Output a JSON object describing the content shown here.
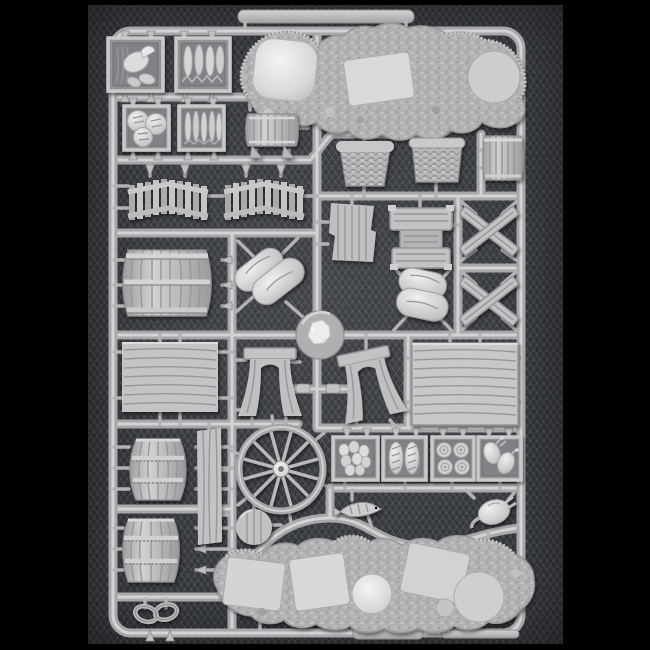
{
  "scene": {
    "type": "photograph",
    "subject": "Injection-moulded light-grey plastic model sprue of miniature wargaming baggage and scenery accessories",
    "background": "dark charcoal herringbone-weave fabric",
    "framing": "black letterbox bars at left, right, top and bottom edges",
    "visible_text": "none"
  },
  "colors": {
    "letterbox": "#000000",
    "fabric": "#3a3d41",
    "plastic_base": "#b4b4b7",
    "plastic_highlight": "#e9e9eb",
    "plastic_shadow": "#8a8a8d"
  },
  "sprue": {
    "frame": "rounded rectangular runner frame with moulded blank label tabs on top and bottom rails",
    "hub": "central circular injection hub with rough gate nub",
    "parts": [
      {
        "name": "crate-of-meat",
        "qty": 1,
        "location": "top-left, row 1 left"
      },
      {
        "name": "crate-of-fish",
        "qty": 1,
        "location": "top-left, row 1 right"
      },
      {
        "name": "crate-of-bread-loaves",
        "qty": 1,
        "location": "top-left, row 2 left"
      },
      {
        "name": "crate-of-dried-fish",
        "qty": 1,
        "location": "top-left, row 2 right"
      },
      {
        "name": "angled-plank-fence-section",
        "qty": 2,
        "location": "left, third row"
      },
      {
        "name": "large-banded-cask",
        "qty": 1,
        "location": "left middle"
      },
      {
        "name": "small-cask-on-stand",
        "qty": 1,
        "location": "upper middle-left"
      },
      {
        "name": "rocky-scenic-base-with-flat-plateaus",
        "qty": 1,
        "location": "top centre, elongated"
      },
      {
        "name": "wicker-basket",
        "qty": 2,
        "location": "upper middle row"
      },
      {
        "name": "slatted-bucket-cask",
        "qty": 1,
        "location": "upper right of basket row"
      },
      {
        "name": "rough-plank-pile",
        "qty": 1,
        "location": "middle, left of centre"
      },
      {
        "name": "banded-plank-stack",
        "qty": 1,
        "location": "middle centre"
      },
      {
        "name": "crossed-beam-barricade-x-frame",
        "qty": 2,
        "location": "middle right column"
      },
      {
        "name": "stacked-sack-pile-large",
        "qty": 1,
        "location": "centre-left, diagonal"
      },
      {
        "name": "stacked-sack-pile-small",
        "qty": 1,
        "location": "centre-right, diagonal"
      },
      {
        "name": "sprue-injection-hub",
        "qty": 1,
        "location": "dead centre"
      },
      {
        "name": "wood-plank-panel",
        "qty": 2,
        "location": "mid band, far left and right"
      },
      {
        "name": "cart-end-arch-board",
        "qty": 2,
        "location": "mid band, flanking centre"
      },
      {
        "name": "long-plank-board",
        "qty": 1,
        "location": "lower left of centre, vertical"
      },
      {
        "name": "twelve-spoke-wagon-wheel",
        "qty": 1,
        "location": "lower centre-left"
      },
      {
        "name": "round-wooden-lid",
        "qty": 1,
        "location": "below wagon wheel"
      },
      {
        "name": "upright-barrel",
        "qty": 2,
        "location": "lower left column"
      },
      {
        "name": "double-ring-shackle-link",
        "qty": 1,
        "location": "bottom left corner"
      },
      {
        "name": "crate-of-eggs",
        "qty": 1,
        "location": "lower food-crate row 1"
      },
      {
        "name": "crate-of-baguette-loaves",
        "qty": 1,
        "location": "lower food-crate row 2"
      },
      {
        "name": "crate-of-rope-coils",
        "qty": 1,
        "location": "lower food-crate row 3"
      },
      {
        "name": "crate-of-poultry",
        "qty": 1,
        "location": "lower food-crate row 4"
      },
      {
        "name": "fish-on-spit",
        "qty": 1,
        "location": "bottom centre small part"
      },
      {
        "name": "plucked-fowl",
        "qty": 1,
        "location": "bottom right small part"
      },
      {
        "name": "rocky-scenic-base-strip-with-round-and-square-plateaus",
        "qty": 1,
        "location": "bottom, elongated"
      }
    ]
  }
}
